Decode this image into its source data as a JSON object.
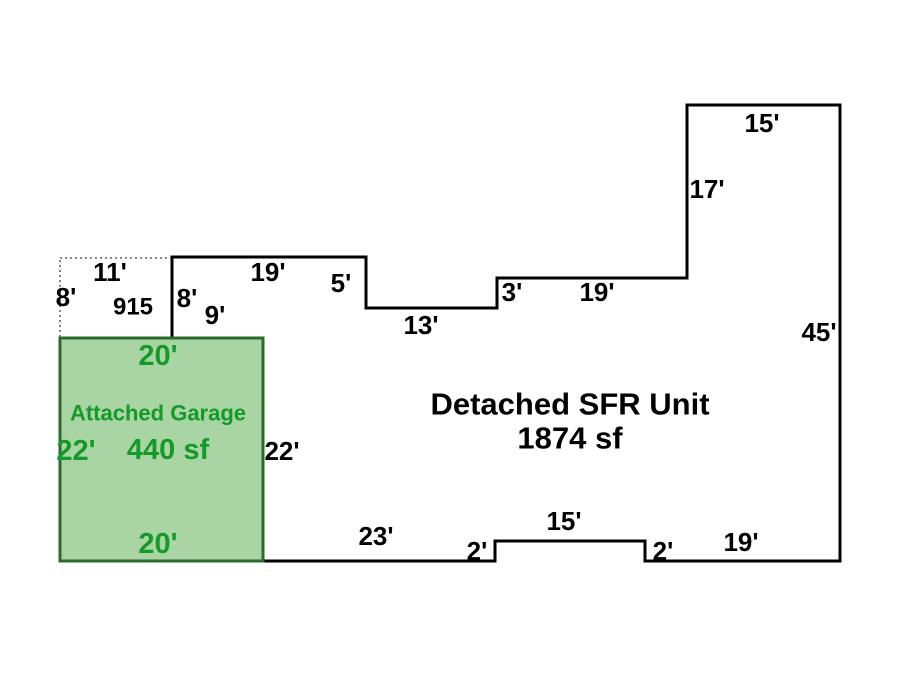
{
  "diagram": {
    "title": "Property sketch: Detached SFR Unit with Attached Garage",
    "units": "feet",
    "canvas": {
      "width": 900,
      "height": 675,
      "background": "#ffffff"
    },
    "colors": {
      "label": "#000000",
      "outline": "#000000",
      "garage_fill": "#a8d5a3",
      "garage_border": "#2d6b2d",
      "garage_text": "#149a28",
      "porch_border": "#404040"
    },
    "structures": {
      "main_unit": {
        "name": "Detached SFR Unit",
        "area": "1874 sf",
        "fill": "none",
        "outline_color": "#000000",
        "outline_width": 3,
        "points": [
          [
            172,
            257
          ],
          [
            366,
            257
          ],
          [
            366,
            308
          ],
          [
            497,
            308
          ],
          [
            497,
            278
          ],
          [
            687,
            278
          ],
          [
            687,
            105
          ],
          [
            840,
            105
          ],
          [
            840,
            561
          ],
          [
            645,
            561
          ],
          [
            645,
            541
          ],
          [
            495,
            541
          ],
          [
            495,
            561
          ],
          [
            263,
            561
          ],
          [
            263,
            338
          ],
          [
            172,
            338
          ]
        ],
        "side_dimensions_ft": [
          19,
          5,
          13,
          3,
          19,
          17,
          15,
          45,
          19,
          2,
          15,
          2,
          23,
          22,
          9,
          8
        ]
      },
      "garage": {
        "name": "Attached Garage",
        "area": "440 sf",
        "rect": {
          "x": 60,
          "y": 338,
          "w": 203,
          "h": 223
        },
        "fill": "#a8d5a3",
        "border_color": "#2d6b2d",
        "border_width": 3,
        "side_dimensions_ft": [
          20,
          22,
          20,
          22
        ]
      },
      "porch": {
        "label": "915",
        "rect": {
          "x": 60,
          "y": 258,
          "w": 112,
          "h": 80
        },
        "border_color": "#404040",
        "border_style": "dotted",
        "side_dimensions_ft": [
          11,
          8
        ]
      }
    },
    "labels": [
      {
        "name": "dim-porch-left-8",
        "text": "8'",
        "x": 66,
        "y": 297,
        "size": 26,
        "fill": "#000000"
      },
      {
        "name": "dim-porch-top-11",
        "text": "11'",
        "x": 110,
        "y": 272,
        "size": 26,
        "fill": "#000000"
      },
      {
        "name": "porch-area-915",
        "text": "915",
        "x": 133,
        "y": 307,
        "size": 24,
        "fill": "#000000"
      },
      {
        "name": "dim-unit-left-8",
        "text": "8'",
        "x": 187,
        "y": 298,
        "size": 26,
        "fill": "#000000"
      },
      {
        "name": "dim-unit-bottomleft-9",
        "text": "9'",
        "x": 215,
        "y": 315,
        "size": 26,
        "fill": "#000000"
      },
      {
        "name": "dim-top-19",
        "text": "19'",
        "x": 268,
        "y": 272,
        "size": 26,
        "fill": "#000000"
      },
      {
        "name": "dim-top-5",
        "text": "5'",
        "x": 341,
        "y": 283,
        "size": 26,
        "fill": "#000000"
      },
      {
        "name": "dim-top-13",
        "text": "13'",
        "x": 421,
        "y": 325,
        "size": 26,
        "fill": "#000000"
      },
      {
        "name": "dim-top-3",
        "text": "3'",
        "x": 512,
        "y": 292,
        "size": 26,
        "fill": "#000000"
      },
      {
        "name": "dim-top-19b",
        "text": "19'",
        "x": 597,
        "y": 292,
        "size": 26,
        "fill": "#000000"
      },
      {
        "name": "dim-tower-left-17",
        "text": "17'",
        "x": 707,
        "y": 189,
        "size": 26,
        "fill": "#000000"
      },
      {
        "name": "dim-tower-top-15",
        "text": "15'",
        "x": 762,
        "y": 123,
        "size": 26,
        "fill": "#000000"
      },
      {
        "name": "dim-right-45",
        "text": "45'",
        "x": 819,
        "y": 332,
        "size": 26,
        "fill": "#000000"
      },
      {
        "name": "dim-bottom-19",
        "text": "19'",
        "x": 741,
        "y": 542,
        "size": 26,
        "fill": "#000000"
      },
      {
        "name": "dim-bottom-2-right",
        "text": "2'",
        "x": 663,
        "y": 551,
        "size": 26,
        "fill": "#000000"
      },
      {
        "name": "dim-bottom-15",
        "text": "15'",
        "x": 564,
        "y": 521,
        "size": 26,
        "fill": "#000000"
      },
      {
        "name": "dim-bottom-2-left",
        "text": "2'",
        "x": 477,
        "y": 551,
        "size": 26,
        "fill": "#000000"
      },
      {
        "name": "dim-bottom-23",
        "text": "23'",
        "x": 376,
        "y": 536,
        "size": 26,
        "fill": "#000000"
      },
      {
        "name": "dim-garage-right-22",
        "text": "22'",
        "x": 282,
        "y": 451,
        "size": 26,
        "fill": "#000000"
      },
      {
        "name": "unit-title",
        "text": "Detached SFR Unit",
        "x": 570,
        "y": 404,
        "size": 31,
        "fill": "#000000"
      },
      {
        "name": "unit-area",
        "text": "1874 sf",
        "x": 570,
        "y": 438,
        "size": 31,
        "fill": "#000000"
      },
      {
        "name": "dim-garage-top-20",
        "text": "20'",
        "x": 158,
        "y": 356,
        "size": 29,
        "fill": "#149a28"
      },
      {
        "name": "garage-title",
        "text": "Attached Garage",
        "x": 158,
        "y": 413,
        "size": 22,
        "fill": "#149a28"
      },
      {
        "name": "dim-garage-left-22",
        "text": "22'",
        "x": 76,
        "y": 451,
        "size": 29,
        "fill": "#149a28"
      },
      {
        "name": "garage-area",
        "text": "440 sf",
        "x": 168,
        "y": 450,
        "size": 29,
        "fill": "#149a28"
      },
      {
        "name": "dim-garage-bottom-20",
        "text": "20'",
        "x": 158,
        "y": 544,
        "size": 29,
        "fill": "#149a28"
      }
    ]
  }
}
